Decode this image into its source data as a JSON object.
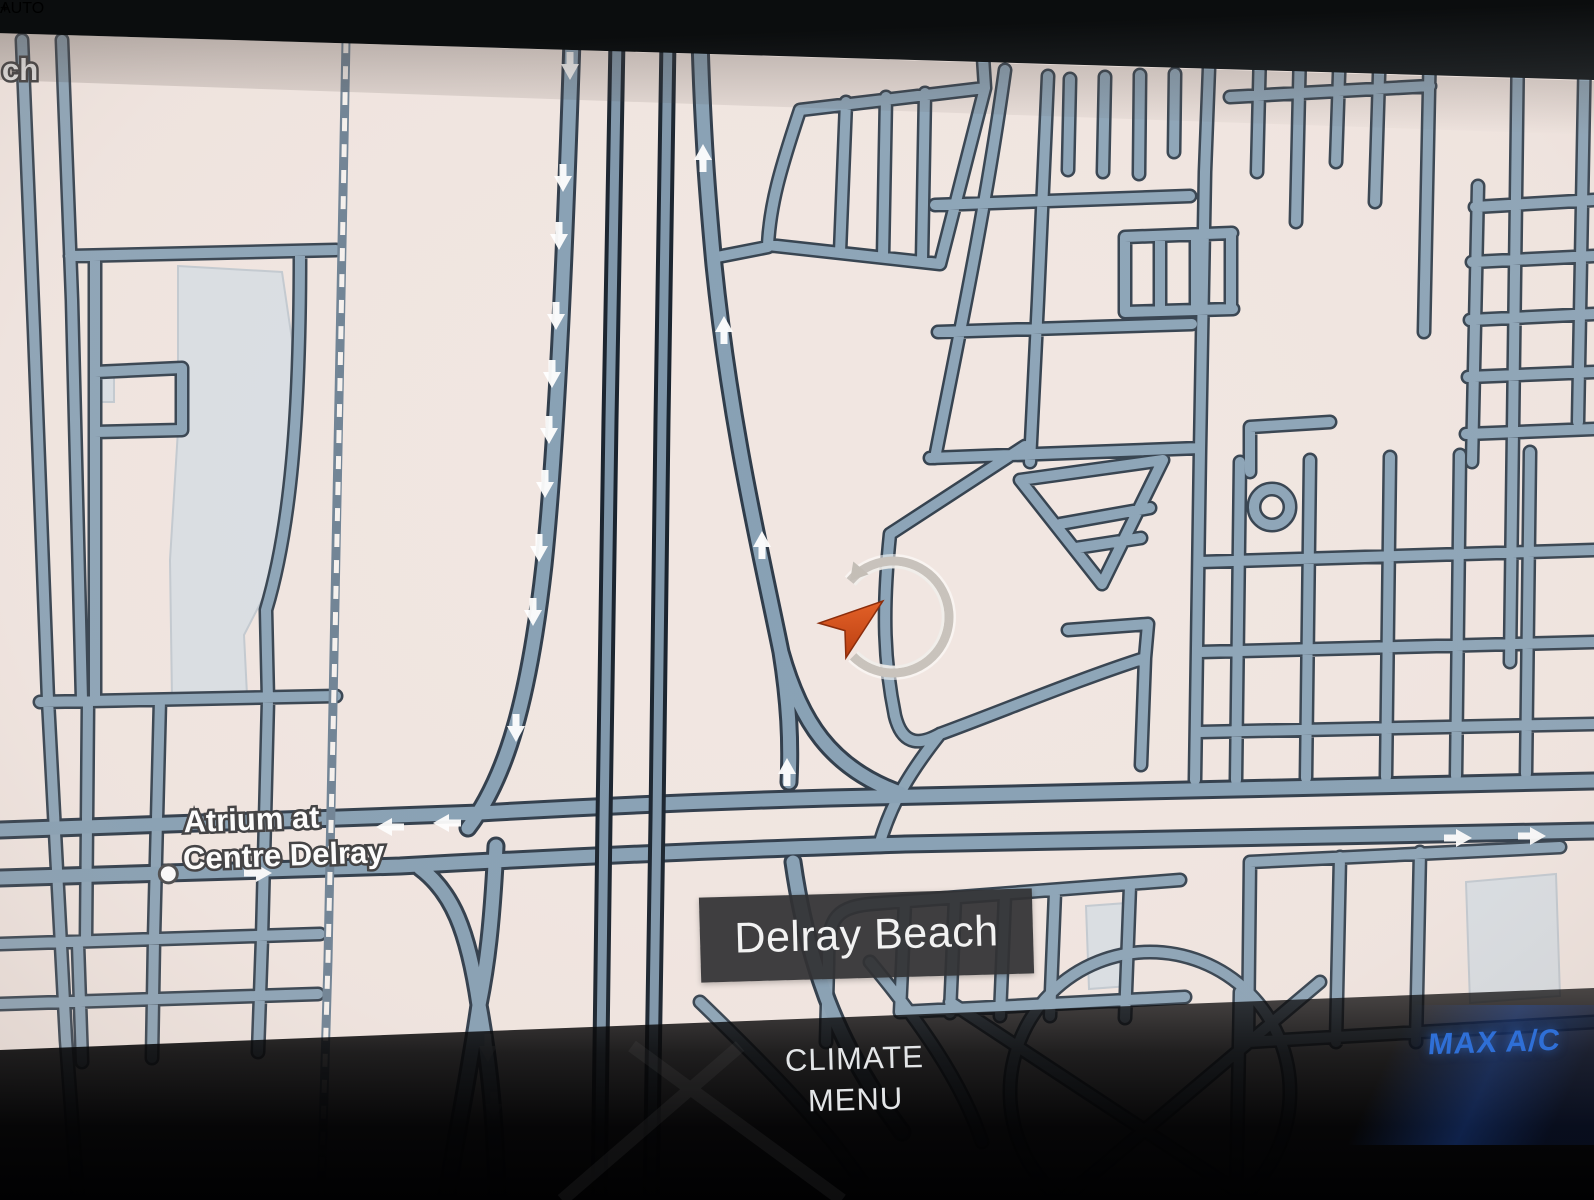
{
  "map": {
    "city_label": "Delray Beach",
    "poi": {
      "line1": "Atrium at",
      "line2": "Centre Delray"
    },
    "edge_label_fragment": "ch",
    "colors": {
      "background": "#f1e6e1",
      "road_fill": "#8ca4b7",
      "road_casing": "#35424f",
      "building": "#dadfe4",
      "marker_orange": "#e0531c",
      "marker_ring_silver": "#c8c2bb"
    }
  },
  "climate_bar": {
    "climate_button": {
      "line1": "CLIMATE",
      "line2": "MENU"
    },
    "max_ac_label": "MAX A/C",
    "auto_label": "AUTO",
    "zoom_in_symbol": "+",
    "accent_blue": "#2f6fd6",
    "accent_red": "#d50f28"
  }
}
